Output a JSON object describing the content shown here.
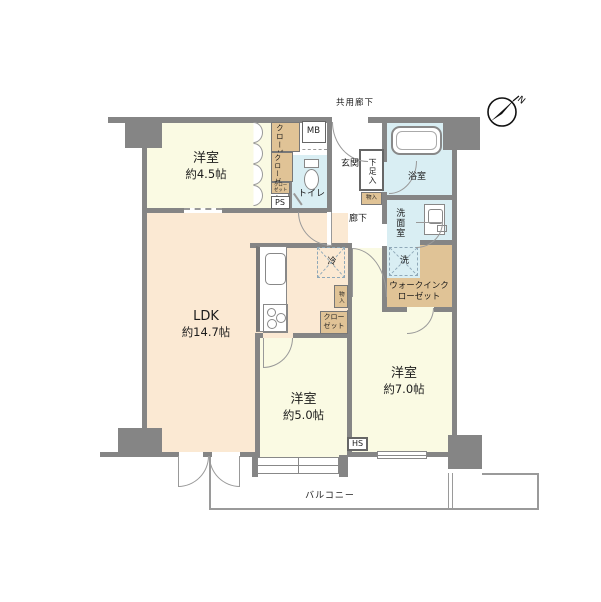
{
  "colors": {
    "wall": "#858585",
    "room_cream": "#FAFAE3",
    "room_peach": "#FBE9D3",
    "wet_blue": "#D9EEF3",
    "closet_tan": "#E0C396",
    "line": "#9a9a9a"
  },
  "compass": {
    "label": "N"
  },
  "areas": {
    "shared_corridor": "共用廊下",
    "balcony": "バルコニー",
    "entrance": "玄関",
    "hallway": "廊下",
    "toilet": "トイレ",
    "bath": "浴室",
    "washroom": "洗面室",
    "bedroom1": {
      "name": "洋室",
      "size": "約4.5帖"
    },
    "bedroom2": {
      "name": "洋室",
      "size": "約5.0帖"
    },
    "bedroom3": {
      "name": "洋室",
      "size": "約7.0帖"
    },
    "ldk": {
      "name": "LDK",
      "size": "約14.7帖"
    },
    "wic": "ウォークインクローゼット"
  },
  "storage": {
    "closet_a": "クローゼット",
    "closet_b": "クローゼット",
    "closet_small": "クローゼット",
    "closet_c": "クローゼット",
    "shoe_cabinet": "下足入",
    "storage_entry": "物入",
    "storage_kitchen": "物入"
  },
  "boxes": {
    "mb": "MB",
    "ps": "PS",
    "hs": "HS"
  },
  "appliances": {
    "fridge": "冷",
    "washer": "洗"
  }
}
